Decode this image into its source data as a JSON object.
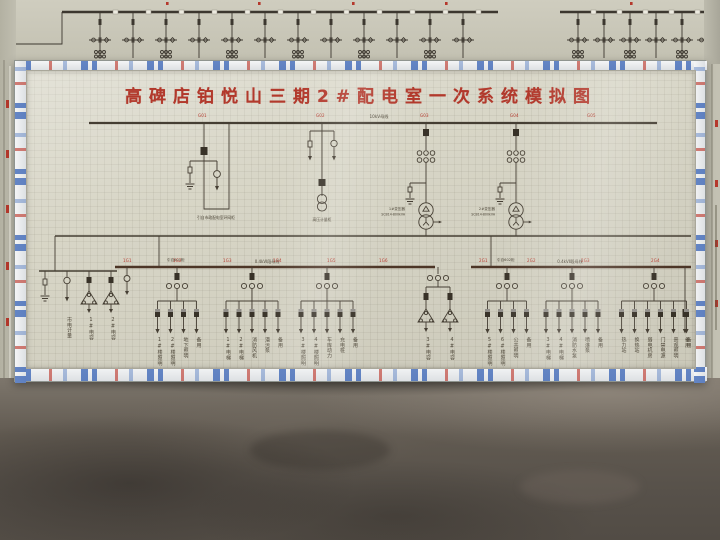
{
  "colors": {
    "title_red": "#b2392c",
    "panel_beige": "#d8d6c7",
    "line_dark": "#453e33",
    "bus_brown": "#4c3526",
    "tag_red": "#b5382c",
    "frame_film_blue": "#3460b4",
    "floor_gray": "#5d564e"
  },
  "board": {
    "title": "高碑店铂悦山三期2#配电室一次系统模拟图",
    "hv": {
      "bus_label": "10kV母线",
      "incoming_label": "引自市政配电室环网柜",
      "metering_label": "高压计量柜",
      "cabinet_tags": [
        "G01",
        "G02",
        "G03",
        "G04",
        "G05"
      ],
      "transformers": [
        {
          "name": "1#变压器",
          "spec": "SCB14-800kVA"
        },
        {
          "name": "2#变压器",
          "spec": "SCB14-800kVA"
        }
      ]
    },
    "lv": {
      "bus1_label": "0.4kVⅠ段母线",
      "bus1_feed_label": "引自601柜",
      "bus1_tags": [
        "1G1",
        "1G2",
        "1G3",
        "1G4",
        "1G5",
        "1G6"
      ],
      "bus2_label": "0.4kVⅡ段母线",
      "bus2_feed_label": "引自602柜",
      "bus2_tags": [
        "2G1",
        "2G2",
        "2G3",
        "2G4"
      ],
      "left_section_labels": [
        "市电计量",
        "1#电容",
        "2#电容"
      ],
      "capacitor_labels": [
        "3#电容",
        "4#电容"
      ],
      "spare_label": "备用",
      "groups": [
        {
          "feeders": [
            "1#楼照明",
            "2#楼照明",
            "地下照明",
            "备用"
          ]
        },
        {
          "feeders": [
            "1#电梯",
            "2#电梯",
            "消防风机",
            "潜污泵",
            "备用"
          ]
        },
        {
          "feeders": [
            "3#楼照明",
            "4#楼照明",
            "车库动力",
            "充电桩",
            "备用"
          ]
        },
        {
          "feeders": [
            "5#楼照明",
            "6#楼照明",
            "公共照明",
            "备用"
          ]
        },
        {
          "feeders": [
            "3#电梯",
            "4#电梯",
            "消防水泵",
            "喷淋泵",
            "备用"
          ]
        },
        {
          "feeders": [
            "热力站",
            "换热站",
            "弱电机房",
            "门禁电源",
            "景观照明",
            "备用"
          ]
        }
      ]
    }
  }
}
